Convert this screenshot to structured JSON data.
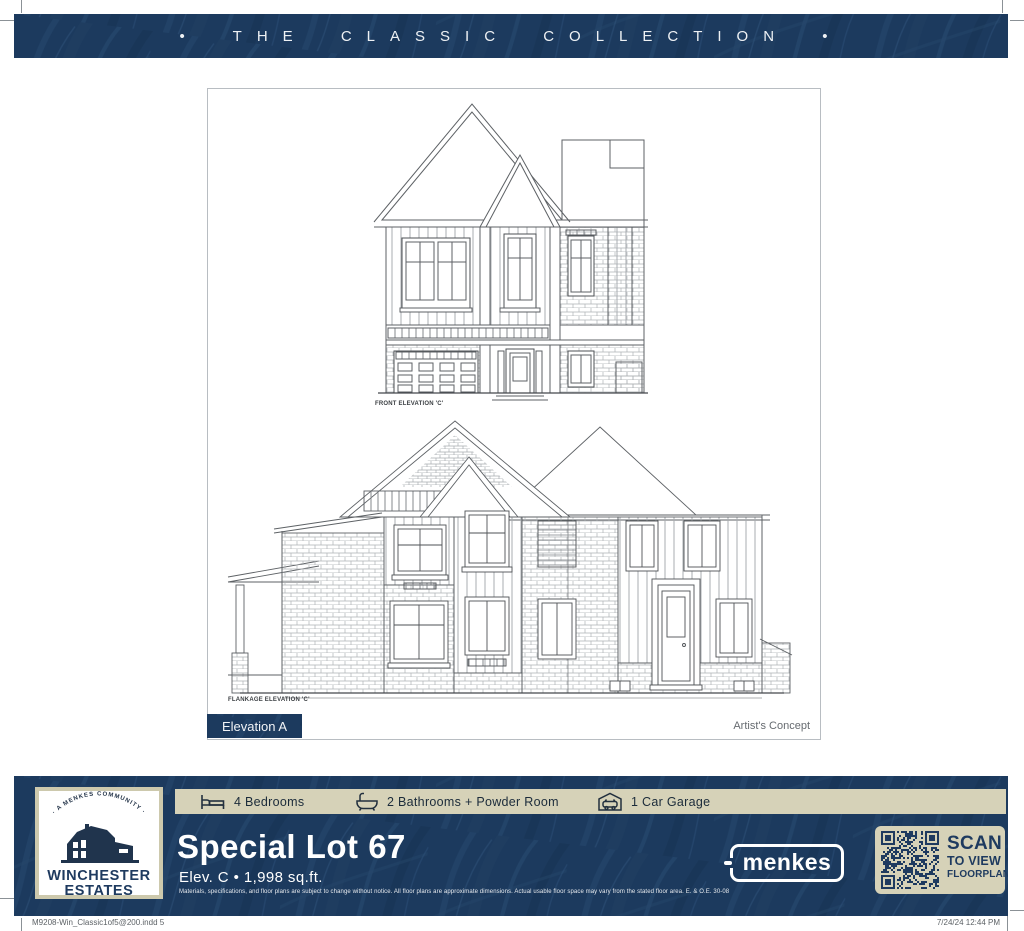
{
  "banner": {
    "text": "• THE CLASSIC COLLECTION •"
  },
  "drawing_panel": {
    "front_elevation_label": "FRONT ELEVATION 'C'",
    "flankage_elevation_label": "FLANKAGE ELEVATION 'C'",
    "elevation_badge": "Elevation A",
    "artists_concept": "Artist's Concept"
  },
  "community_logo": {
    "tagline": "· A MENKES COMMUNITY ·",
    "name_line1": "WINCHESTER",
    "name_line2": "ESTATES",
    "icon": "barn-icon"
  },
  "specs": [
    {
      "icon": "bed-icon",
      "label": "4 Bedrooms"
    },
    {
      "icon": "bath-icon",
      "label": "2 Bathrooms + Powder Room"
    },
    {
      "icon": "garage-icon",
      "label": "1 Car Garage"
    }
  ],
  "lot": {
    "title": "Special Lot 67",
    "subtitle": "Elev. C • 1,998 sq.ft.",
    "disclaimer": "Materials, specifications, and floor plans are subject to change without notice. All floor plans are approximate dimensions. Actual usable floor space may vary from the stated floor area. E. & O.E. 30-08"
  },
  "builder": {
    "logo_text": "menkes"
  },
  "qr_panel": {
    "icon": "qr-code",
    "line1": "SCAN",
    "line2": "TO VIEW",
    "line3": "FLOORPLAN"
  },
  "print_footer": {
    "left": "M9208-Win_Classic1of5@200.indd   5",
    "right": "7/24/24   12:44 PM"
  },
  "colors": {
    "navy": "#1c3a5e",
    "navy_leaf": "#27496f",
    "beige": "#d6d2b8",
    "logo_border": "#cdc9ad",
    "navy_text": "#1e3a5f",
    "white": "#ffffff"
  }
}
